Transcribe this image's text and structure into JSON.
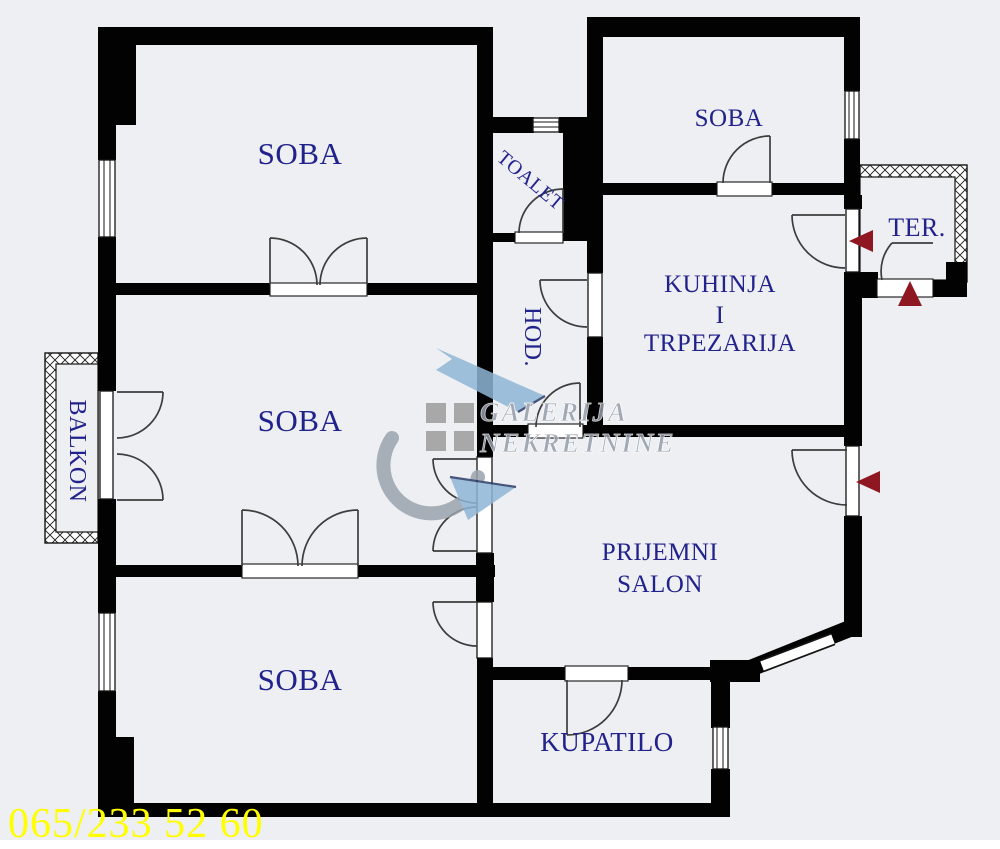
{
  "colors": {
    "background": "#edeff2",
    "wall": "#020202",
    "room_label": "#22228c",
    "entrance_arrow": "#8e1722",
    "phone_text": "#ffff00",
    "watermark_text": "#949dab",
    "watermark_blue": "#8fb6d6",
    "watermark_grey": "#9aa3ae"
  },
  "rooms": {
    "soba_top_left": "SOBA",
    "soba_top_right": "SOBA",
    "soba_middle": "SOBA",
    "soba_bottom": "SOBA",
    "toalet": "TOALET",
    "hodnik": "HOD.",
    "kuhinja_line1": "KUHINJA",
    "kuhinja_line2": "I",
    "kuhinja_line3": "TRPEZARIJA",
    "terasa": "TER.",
    "balkon": "BALKON",
    "prijemni_line1": "PRIJEMNI",
    "prijemni_line2": "SALON",
    "kupatilo": "KUPATILO"
  },
  "watermark": {
    "line1": "GALERIJA",
    "line2": "NEKRETNINE"
  },
  "footer": {
    "phone": "065/233 52 60"
  }
}
